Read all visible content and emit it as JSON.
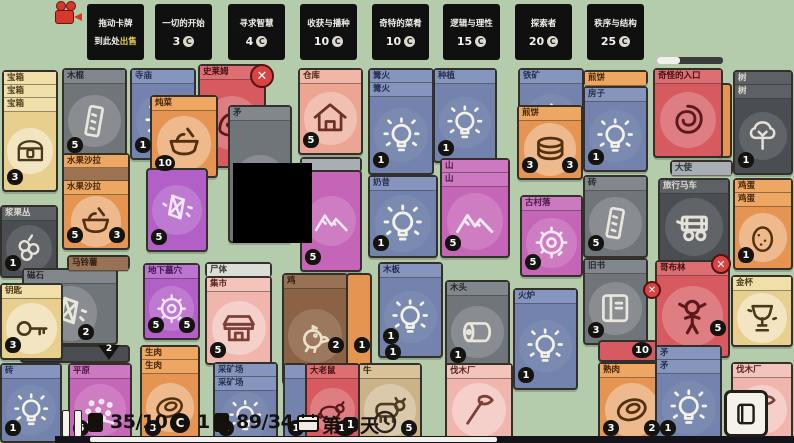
{
  "palette": {
    "yellow": {
      "bg": "#e9cf8e",
      "bar": "#f1dfa9",
      "tc": "#4a3a1c",
      "ink": "#4a3a1c",
      "circ": "rgba(255,255,255,0.45)"
    },
    "gray": {
      "bg": "#70757a",
      "bar": "#82878d",
      "tc": "#24272b",
      "ink": "#e9e6dc",
      "circ": "rgba(255,255,255,0.18)"
    },
    "darkgray": {
      "bg": "#4a4e52",
      "bar": "#5d6166",
      "tc": "#dfdbd0",
      "ink": "#e4e1d6",
      "circ": "rgba(255,255,255,0.12)"
    },
    "blue": {
      "bg": "#7383ad",
      "bar": "#8595bd",
      "tc": "#282f4e",
      "ink": "#f3f1e8",
      "circ": "rgba(255,255,255,0.06)"
    },
    "red": {
      "bg": "#d65a5f",
      "bar": "#de6e72",
      "tc": "#421114",
      "ink": "#5c191c",
      "circ": "rgba(255,255,255,0.22)"
    },
    "salmon": {
      "bg": "#eca593",
      "bar": "#f1b6a5",
      "tc": "#4c221a",
      "ink": "#6b3126",
      "circ": "rgba(255,255,255,0.3)"
    },
    "pink": {
      "bg": "#f0b5ad",
      "bar": "#f4c4bc",
      "tc": "#57281f",
      "ink": "#7c4038",
      "circ": "rgba(255,255,255,0.35)"
    },
    "orange": {
      "bg": "#e59551",
      "bar": "#eda763",
      "tc": "#432508",
      "ink": "#53300f",
      "circ": "rgba(255,255,255,0.35)"
    },
    "magenta": {
      "bg": "#c565b7",
      "bar": "#cd79c2",
      "tc": "#471743",
      "ink": "#f6e9f4",
      "circ": "rgba(255,255,255,0.16)"
    },
    "purple": {
      "bg": "#b260c8",
      "bar": "#bb74cf",
      "tc": "#3f1650",
      "ink": "#f3e7f8",
      "circ": "rgba(255,255,255,0.16)"
    },
    "brown": {
      "bg": "#8b6244",
      "bar": "#997155",
      "tc": "#2b1d10",
      "ink": "#ecdfc8",
      "circ": "rgba(255,255,255,0.14)"
    },
    "tan": {
      "bg": "#ccb289",
      "bar": "#d7c29a",
      "tc": "#33270f",
      "ink": "#4f3c22",
      "circ": "rgba(255,255,255,0.3)"
    },
    "bluegray": {
      "bg": "#a9aeb3",
      "bar": "#a9aeb3",
      "tc": "#2e3237",
      "ink": "#2e3237",
      "circ": "rgba(255,255,255,0.2)"
    },
    "white": {
      "bg": "#dcdcd8",
      "bar": "#dcdcd8",
      "tc": "#37352f",
      "ink": "#37352f",
      "circ": "rgba(255,255,255,0.3)"
    },
    "black": {
      "bg": "#000000",
      "bar": "#000000",
      "tc": "#ffffff",
      "ink": "#ffffff",
      "circ": "rgba(0,0,0,0)"
    }
  },
  "hud_top": {
    "sell_zone": {
      "line1": "拖动卡牌",
      "line2_pre": "到此处",
      "line2_em": "出售",
      "x": 87
    },
    "quests": [
      {
        "title": "一切的开始",
        "cost": "3",
        "x": 155
      },
      {
        "title": "寻求智慧",
        "cost": "4",
        "x": 228
      },
      {
        "title": "收获与播种",
        "cost": "10",
        "x": 300
      },
      {
        "title": "奇特的菜肴",
        "cost": "10",
        "x": 372
      },
      {
        "title": "逻辑与理性",
        "cost": "15",
        "x": 443
      },
      {
        "title": "探索者",
        "cost": "20",
        "x": 515
      },
      {
        "title": "秩序与结构",
        "cost": "25",
        "x": 587
      }
    ],
    "progress_percent": 35
  },
  "hud_bottom": {
    "cards_counter": "35/10",
    "coins": "1",
    "food_counter": "89/34",
    "day_prefix": "第",
    "day_number": "1",
    "day_suffix": "天",
    "bottom_progress_percent": 55
  },
  "xbuttons": [
    {
      "x": 250,
      "y": 64,
      "s": 24,
      "label": "✕"
    },
    {
      "x": 643,
      "y": 281,
      "s": 18,
      "label": "✕"
    },
    {
      "x": 711,
      "y": 254,
      "s": 20,
      "label": "✕"
    }
  ],
  "board": {
    "cards": [
      {
        "n": "treasure-chest",
        "t": "宝箱",
        "b": [
          "宝箱",
          "宝箱"
        ],
        "x": 2,
        "y": 70,
        "w": 56,
        "h": 122,
        "c": "yellow",
        "ic": "chest",
        "bd": [
          {
            "v": "3",
            "p": "bl"
          }
        ]
      },
      {
        "n": "berry-bush",
        "t": "浆果丛",
        "x": 0,
        "y": 205,
        "w": 58,
        "h": 73,
        "c": "darkgray",
        "ic": "berries",
        "bd": [
          {
            "v": "1",
            "p": "bl"
          }
        ]
      },
      {
        "n": "lodestone",
        "t": "磁石",
        "x": 22,
        "y": 268,
        "w": 96,
        "h": 77,
        "c": "gray",
        "ic": "crystal",
        "bd": [
          {
            "v": "2",
            "p": [
              54,
              54
            ]
          }
        ]
      },
      {
        "n": "card-stack-under",
        "x": 20,
        "y": 345,
        "w": 110,
        "h": 18,
        "c": "darkgray",
        "plain": true,
        "arrow": "2"
      },
      {
        "n": "key",
        "t": "钥匙",
        "x": 0,
        "y": 283,
        "w": 63,
        "h": 77,
        "c": "yellow",
        "ic": "key",
        "bd": [
          {
            "v": "3",
            "p": "bl"
          }
        ]
      },
      {
        "n": "brick-idea",
        "t": "砖",
        "x": 0,
        "y": 363,
        "w": 62,
        "h": 80,
        "c": "blue",
        "ic": "bulb",
        "bd": [
          {
            "v": "1",
            "p": "bl"
          }
        ]
      },
      {
        "n": "stick",
        "t": "木棍",
        "x": 62,
        "y": 68,
        "w": 65,
        "h": 92,
        "c": "gray",
        "ic": "plank",
        "bd": [
          {
            "v": "5",
            "p": "bl"
          }
        ]
      },
      {
        "n": "fruit-salad",
        "t": "水果沙拉",
        "b": [
          "水果沙拉",
          {
            "t": "",
            "bg": "#9c7250"
          }
        ],
        "x": 62,
        "y": 153,
        "w": 68,
        "h": 97,
        "c": "orange",
        "ic": "bowl",
        "bd": [
          {
            "v": "5",
            "p": "bl"
          },
          {
            "v": "3",
            "p": "br"
          }
        ]
      },
      {
        "n": "potato-bar",
        "t": "马铃薯",
        "x": 67,
        "y": 255,
        "w": 63,
        "h": 15,
        "c": "brown"
      },
      {
        "n": "plains",
        "t": "平原",
        "x": 68,
        "y": 363,
        "w": 64,
        "h": 80,
        "c": "magenta",
        "ic": "dots",
        "bd": [
          {
            "v": "5",
            "p": "bl"
          }
        ]
      },
      {
        "n": "temple-idea",
        "t": "寺庙",
        "x": 130,
        "y": 68,
        "w": 66,
        "h": 92,
        "c": "blue",
        "ic": "bulb",
        "bd": [
          {
            "v": "1",
            "p": "bl"
          }
        ]
      },
      {
        "n": "slime",
        "t": "史莱姆",
        "x": 198,
        "y": 64,
        "w": 68,
        "h": 104,
        "c": "red",
        "ic": "blob"
      },
      {
        "n": "stew",
        "t": "炖菜",
        "x": 150,
        "y": 95,
        "w": 68,
        "h": 83,
        "c": "orange",
        "ic": "bowl",
        "bd": [
          {
            "v": "10",
            "p": "bl"
          }
        ]
      },
      {
        "n": "mystery-card",
        "x": 146,
        "y": 168,
        "w": 62,
        "h": 84,
        "c": "purple",
        "notitle": true,
        "ic": "crystal",
        "bd": [
          {
            "v": "5",
            "p": "bl"
          }
        ]
      },
      {
        "n": "spear",
        "t": "矛",
        "x": 228,
        "y": 105,
        "w": 64,
        "h": 138,
        "c": "gray",
        "ic": "spear"
      },
      {
        "n": "catacombs",
        "t": "地下墓穴",
        "x": 143,
        "y": 263,
        "w": 57,
        "h": 77,
        "c": "purple",
        "ic": "ring",
        "bd": [
          {
            "v": "5",
            "p": "bl"
          },
          {
            "v": "5",
            "p": "br"
          }
        ]
      },
      {
        "n": "raw-meat",
        "t": "生肉",
        "b": [
          "生肉"
        ],
        "x": 140,
        "y": 345,
        "w": 60,
        "h": 98,
        "c": "orange",
        "ic": "meat",
        "bd": [
          {
            "v": "3",
            "p": "bl"
          }
        ]
      },
      {
        "n": "corpse-bar",
        "t": "尸体",
        "x": 205,
        "y": 262,
        "w": 67,
        "h": 15,
        "c": "white"
      },
      {
        "n": "market",
        "t": "集市",
        "x": 205,
        "y": 276,
        "w": 67,
        "h": 89,
        "c": "pink",
        "ic": "tent",
        "bd": [
          {
            "v": "5",
            "p": "bl"
          }
        ]
      },
      {
        "n": "quarry-idea",
        "t": "采矿场",
        "b": [
          "采矿场"
        ],
        "x": 213,
        "y": 362,
        "w": 65,
        "h": 81,
        "c": "blue",
        "ic": "bulb",
        "bd": [
          {
            "v": "1",
            "p": "bl"
          }
        ]
      },
      {
        "n": "warehouse",
        "t": "仓库",
        "x": 298,
        "y": 68,
        "w": 65,
        "h": 87,
        "c": "salmon",
        "ic": "house",
        "bd": [
          {
            "v": "5",
            "p": "bl"
          }
        ]
      },
      {
        "n": "untitled-bar",
        "t": "",
        "x": 300,
        "y": 157,
        "w": 62,
        "h": 15,
        "c": "bluegray"
      },
      {
        "n": "mountain-card-back",
        "x": 300,
        "y": 170,
        "w": 62,
        "h": 102,
        "c": "magenta",
        "notitle": true,
        "ic": "mountain",
        "bd": [
          {
            "v": "5",
            "p": "bl"
          }
        ]
      },
      {
        "n": "black-overlay",
        "x": 233,
        "y": 163,
        "w": 79,
        "h": 80,
        "c": "black",
        "plain": true,
        "ni": true
      },
      {
        "n": "card-sliver",
        "x": 346,
        "y": 273,
        "w": 26,
        "h": 112,
        "c": "orange",
        "plain": true,
        "bd": [
          {
            "v": "1",
            "p": [
              6,
              62
            ]
          }
        ]
      },
      {
        "n": "chicken",
        "t": "鸡",
        "x": 282,
        "y": 273,
        "w": 66,
        "h": 112,
        "c": "brown",
        "ic": "bird",
        "bd": [
          {
            "v": "2",
            "p": [
              44,
              62
            ]
          }
        ]
      },
      {
        "n": "partial-card",
        "t": "",
        "x": 283,
        "y": 363,
        "w": 24,
        "h": 80,
        "c": "blue",
        "bd": [
          {
            "v": "1",
            "p": "bl"
          }
        ]
      },
      {
        "n": "giant-rat",
        "t": "大老鼠",
        "x": 305,
        "y": 363,
        "w": 55,
        "h": 80,
        "c": "red",
        "ic": "rat",
        "bd": [
          {
            "v": "12",
            "p": "br"
          }
        ]
      },
      {
        "n": "campfire-idea",
        "t": "篝火",
        "b": [
          "篝火"
        ],
        "x": 368,
        "y": 68,
        "w": 66,
        "h": 107,
        "c": "blue",
        "ic": "bulb",
        "bd": [
          {
            "v": "1",
            "p": "bl"
          }
        ]
      },
      {
        "n": "milkshake-idea",
        "t": "奶昔",
        "x": 368,
        "y": 175,
        "w": 70,
        "h": 83,
        "c": "blue",
        "ic": "bulb",
        "bd": [
          {
            "v": "1",
            "p": "bl"
          }
        ]
      },
      {
        "n": "plank-idea",
        "t": "木板",
        "x": 378,
        "y": 262,
        "w": 65,
        "h": 96,
        "c": "blue",
        "ic": "bulb",
        "bd": [
          {
            "v": "1",
            "p": [
              3,
              64
            ]
          },
          {
            "v": "1",
            "p": [
              5,
              80
            ]
          }
        ]
      },
      {
        "n": "cow",
        "t": "牛",
        "x": 358,
        "y": 363,
        "w": 64,
        "h": 80,
        "c": "tan",
        "ic": "cowic",
        "bd": [
          {
            "v": "5",
            "p": "br"
          }
        ]
      },
      {
        "n": "planting-idea",
        "t": "种植",
        "x": 433,
        "y": 68,
        "w": 64,
        "h": 95,
        "c": "blue",
        "ic": "bulb",
        "bd": [
          {
            "v": "1",
            "p": "bl"
          }
        ]
      },
      {
        "n": "mountain",
        "t": "山",
        "b": [
          "山"
        ],
        "x": 440,
        "y": 158,
        "w": 70,
        "h": 100,
        "c": "magenta",
        "ic": "mountain",
        "bd": [
          {
            "v": "5",
            "p": "bl"
          }
        ]
      },
      {
        "n": "wood",
        "t": "木头",
        "x": 445,
        "y": 280,
        "w": 65,
        "h": 90,
        "c": "gray",
        "ic": "log",
        "bd": [
          {
            "v": "1",
            "p": "bl"
          }
        ]
      },
      {
        "n": "iron-ore-idea",
        "t": "铁矿",
        "x": 518,
        "y": 68,
        "w": 66,
        "h": 92,
        "c": "blue",
        "ic": "bulb"
      },
      {
        "n": "pancake",
        "t": "煎饼",
        "x": 517,
        "y": 105,
        "w": 66,
        "h": 75,
        "c": "orange",
        "ic": "stack",
        "bd": [
          {
            "v": "3",
            "p": "bl"
          },
          {
            "v": "3",
            "p": "br"
          }
        ]
      },
      {
        "n": "ancient-village",
        "t": "古村落",
        "x": 520,
        "y": 195,
        "w": 63,
        "h": 82,
        "c": "magenta",
        "ic": "ring",
        "bd": [
          {
            "v": "5",
            "p": "bl"
          }
        ]
      },
      {
        "n": "stove-idea",
        "t": "火炉",
        "x": 513,
        "y": 288,
        "w": 65,
        "h": 102,
        "c": "blue",
        "ic": "bulb",
        "bd": [
          {
            "v": "1",
            "p": "bl"
          }
        ]
      },
      {
        "n": "lumber-camp-1",
        "t": "伐木厂",
        "x": 445,
        "y": 363,
        "w": 68,
        "h": 80,
        "c": "pink",
        "ic": "axe"
      },
      {
        "n": "pancake-bar",
        "t": "煎饼",
        "x": 583,
        "y": 70,
        "w": 65,
        "h": 15,
        "c": "orange"
      },
      {
        "n": "house-idea",
        "t": "房子",
        "x": 583,
        "y": 86,
        "w": 65,
        "h": 86,
        "c": "blue",
        "ic": "bulb",
        "bd": [
          {
            "v": "1",
            "p": "bl"
          }
        ]
      },
      {
        "n": "brick",
        "t": "砖",
        "x": 583,
        "y": 175,
        "w": 65,
        "h": 83,
        "c": "gray",
        "ic": "plank",
        "bd": [
          {
            "v": "5",
            "p": "bl"
          }
        ]
      },
      {
        "n": "old-book",
        "t": "旧书",
        "x": 583,
        "y": 258,
        "w": 65,
        "h": 87,
        "c": "gray",
        "ic": "book",
        "bd": [
          {
            "v": "3",
            "p": "bl"
          }
        ]
      },
      {
        "n": "card-sliver-red",
        "x": 598,
        "y": 340,
        "w": 60,
        "h": 22,
        "c": "red",
        "plain": true,
        "bd": [
          {
            "v": "10",
            "p": [
              32,
              0
            ]
          }
        ]
      },
      {
        "n": "cooked-meat",
        "t": "熟肉",
        "x": 598,
        "y": 362,
        "w": 67,
        "h": 81,
        "c": "orange",
        "ic": "meat",
        "bd": [
          {
            "v": "3",
            "p": "bl"
          },
          {
            "v": "2",
            "p": "br"
          }
        ]
      },
      {
        "n": "card-sliver-orange",
        "x": 718,
        "y": 83,
        "w": 14,
        "h": 75,
        "c": "orange",
        "plain": true
      },
      {
        "n": "strange-portal",
        "t": "奇怪的入口",
        "x": 653,
        "y": 68,
        "w": 70,
        "h": 90,
        "c": "red",
        "ic": "swirl"
      },
      {
        "n": "emissary-bar",
        "t": "大使",
        "x": 670,
        "y": 160,
        "w": 63,
        "h": 15,
        "c": "bluegray"
      },
      {
        "n": "travelling-cart",
        "t": "旅行马车",
        "x": 658,
        "y": 178,
        "w": 72,
        "h": 84,
        "c": "darkgray",
        "ic": "cart"
      },
      {
        "n": "goblin",
        "t": "哥布林",
        "x": 655,
        "y": 260,
        "w": 75,
        "h": 98,
        "c": "red",
        "ic": "person",
        "bd": [
          {
            "v": "5",
            "p": [
              53,
              58
            ]
          }
        ]
      },
      {
        "n": "spear-idea",
        "t": "矛",
        "b": [
          "矛"
        ],
        "x": 655,
        "y": 345,
        "w": 67,
        "h": 98,
        "c": "blue",
        "ic": "bulb",
        "bd": [
          {
            "v": "1",
            "p": "bl"
          }
        ]
      },
      {
        "n": "tree",
        "t": "树",
        "b": [
          "树"
        ],
        "x": 733,
        "y": 70,
        "w": 60,
        "h": 105,
        "c": "darkgray",
        "ic": "tree",
        "bd": [
          {
            "v": "1",
            "p": "bl"
          }
        ]
      },
      {
        "n": "egg",
        "t": "鸡蛋",
        "b": [
          "鸡蛋"
        ],
        "x": 733,
        "y": 178,
        "w": 60,
        "h": 92,
        "c": "orange",
        "ic": "eggic",
        "bd": [
          {
            "v": "1",
            "p": "bl"
          }
        ]
      },
      {
        "n": "golden-goblet",
        "t": "金杯",
        "x": 731,
        "y": 275,
        "w": 62,
        "h": 72,
        "c": "yellow",
        "ic": "cup"
      },
      {
        "n": "lumber-camp-2",
        "t": "伐木厂",
        "x": 731,
        "y": 362,
        "w": 62,
        "h": 81,
        "c": "pink",
        "ic": "axe"
      }
    ]
  }
}
